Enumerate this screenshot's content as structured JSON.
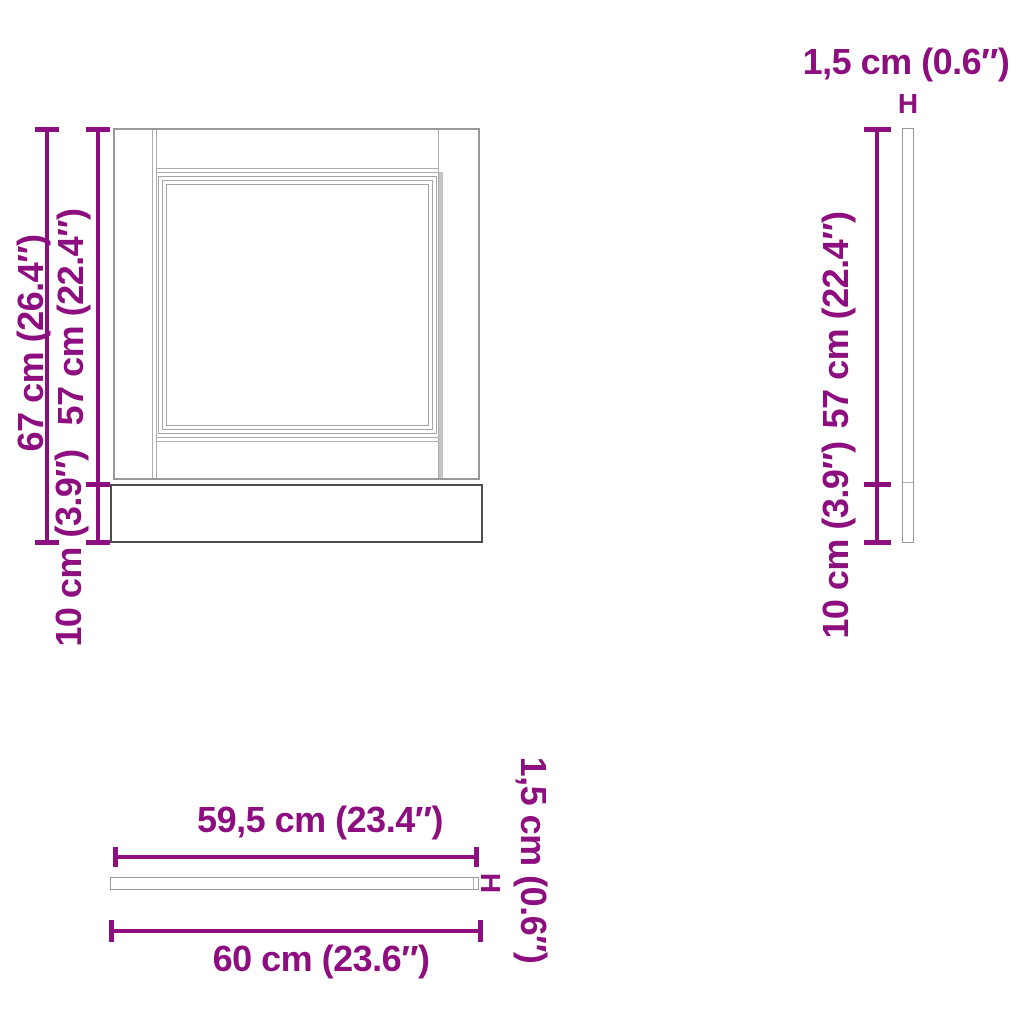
{
  "diagram_type": "furniture-dimension-drawing",
  "colors": {
    "dimension_accent": "#8d0f7f",
    "outline_gray": "#999999",
    "outline_dark": "#4d4d4d",
    "background": "#ffffff"
  },
  "front_view": {
    "total_height": "67 cm (26.4″)",
    "door_height": "57 cm (22.4″)",
    "plinth_height": "10 cm (3.9″)"
  },
  "side_view": {
    "thickness": "1,5 cm (0.6″)",
    "thickness_marker": "H",
    "door_height": "57 cm (22.4″)",
    "plinth_height": "10 cm (3.9″)"
  },
  "top_view": {
    "door_width": "59,5 cm (23.4″)",
    "total_width": "60 cm (23.6″)",
    "thickness": "1,5 cm (0.6″)",
    "thickness_marker": "H"
  }
}
